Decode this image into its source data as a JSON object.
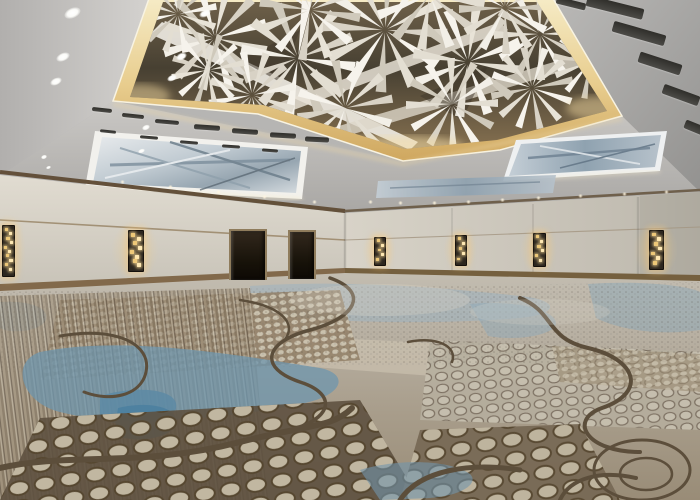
{
  "meta": {
    "description": "Empty hotel ballroom with a sculptural white folded-panel ceiling installation, warm cove lighting, backlit blue-gray ceiling art panels, beige walls with amber glass-cube sconces, two dark door openings, and a large abstract carpet in blues, taupes and browns",
    "width": 700,
    "height": 500
  },
  "palette": {
    "ceiling_light": "#d5d3d0",
    "ceiling_dark": "#9a9997",
    "cove_gold": "#e3c078",
    "sculpture_white": "#f4f1ea",
    "coffer_shadow": "#453c2f",
    "panel_art_blue": "#8fa2b0",
    "wall_beige": "#d6d1c6",
    "wood_trim": "#6b5137",
    "sconce_amber": "#ffe9b4",
    "carpet_blue": "#5d89a4",
    "carpet_blue_bright": "#4d7fa0",
    "carpet_taupe": "#927f66",
    "carpet_beige": "#c6bca6",
    "carpet_dark_vein": "#5c4e3b",
    "carpet_gray": "#b6aea0"
  },
  "scene": {
    "ceiling": {
      "downlights": [
        {
          "x": 72,
          "y": 13,
          "w": 17,
          "h": 10,
          "r": -24
        },
        {
          "x": 63,
          "y": 57,
          "w": 14,
          "h": 8,
          "r": -24
        },
        {
          "x": 56,
          "y": 81,
          "w": 12,
          "h": 7,
          "r": -24
        },
        {
          "x": 205,
          "y": 13,
          "w": 12,
          "h": 7,
          "r": -24
        },
        {
          "x": 181,
          "y": 56,
          "w": 11,
          "h": 7,
          "r": -24
        },
        {
          "x": 172,
          "y": 78,
          "w": 10,
          "h": 6,
          "r": -24
        },
        {
          "x": 146,
          "y": 127,
          "w": 8,
          "h": 5,
          "r": -22
        },
        {
          "x": 141,
          "y": 151,
          "w": 7,
          "h": 4,
          "r": -22
        },
        {
          "x": 44,
          "y": 157,
          "w": 6,
          "h": 4,
          "r": -20
        },
        {
          "x": 48,
          "y": 167,
          "w": 5,
          "h": 3,
          "r": -20
        }
      ],
      "soffit_lights": [
        {
          "x": 120,
          "y": 180
        },
        {
          "x": 168,
          "y": 185
        },
        {
          "x": 216,
          "y": 190
        },
        {
          "x": 262,
          "y": 195
        },
        {
          "x": 312,
          "y": 200
        },
        {
          "x": 368,
          "y": 200
        },
        {
          "x": 398,
          "y": 201
        },
        {
          "x": 432,
          "y": 201
        },
        {
          "x": 466,
          "y": 200
        },
        {
          "x": 500,
          "y": 198
        },
        {
          "x": 536,
          "y": 196
        },
        {
          "x": 578,
          "y": 194
        },
        {
          "x": 622,
          "y": 192
        },
        {
          "x": 664,
          "y": 190
        }
      ],
      "vents": [
        {
          "x": 92,
          "y": 108,
          "w": 20,
          "h": 4,
          "r": 6
        },
        {
          "x": 122,
          "y": 114,
          "w": 22,
          "h": 4,
          "r": 6
        },
        {
          "x": 155,
          "y": 120,
          "w": 24,
          "h": 4,
          "r": 5
        },
        {
          "x": 194,
          "y": 125,
          "w": 26,
          "h": 5,
          "r": 4
        },
        {
          "x": 232,
          "y": 129,
          "w": 26,
          "h": 5,
          "r": 4
        },
        {
          "x": 270,
          "y": 133,
          "w": 26,
          "h": 5,
          "r": 3
        },
        {
          "x": 305,
          "y": 137,
          "w": 24,
          "h": 5,
          "r": 3
        },
        {
          "x": 100,
          "y": 130,
          "w": 16,
          "h": 3,
          "r": 6
        },
        {
          "x": 140,
          "y": 136,
          "w": 18,
          "h": 3,
          "r": 5
        },
        {
          "x": 180,
          "y": 141,
          "w": 18,
          "h": 3,
          "r": 5
        },
        {
          "x": 222,
          "y": 145,
          "w": 18,
          "h": 3,
          "r": 4
        },
        {
          "x": 262,
          "y": 149,
          "w": 16,
          "h": 3,
          "r": 4
        },
        {
          "x": 556,
          "y": 0,
          "w": 30,
          "h": 7,
          "r": 14
        },
        {
          "x": 586,
          "y": 2,
          "w": 58,
          "h": 11,
          "r": 14
        },
        {
          "x": 612,
          "y": 28,
          "w": 54,
          "h": 11,
          "r": 16
        },
        {
          "x": 638,
          "y": 58,
          "w": 44,
          "h": 11,
          "r": 18
        },
        {
          "x": 662,
          "y": 90,
          "w": 38,
          "h": 10,
          "r": 20
        },
        {
          "x": 684,
          "y": 124,
          "w": 26,
          "h": 9,
          "r": 22
        }
      ],
      "fan_clusters": [
        {
          "x": 215,
          "y": 38,
          "s": 1.15,
          "r": -15
        },
        {
          "x": 298,
          "y": 58,
          "s": 1.25,
          "r": 10
        },
        {
          "x": 385,
          "y": 30,
          "s": 1.35,
          "r": 35
        },
        {
          "x": 468,
          "y": 62,
          "s": 1.2,
          "r": -20
        },
        {
          "x": 540,
          "y": 34,
          "s": 1.0,
          "r": 60
        },
        {
          "x": 252,
          "y": 95,
          "s": 0.95,
          "r": 170
        },
        {
          "x": 345,
          "y": 108,
          "s": 1.05,
          "r": 200
        },
        {
          "x": 452,
          "y": 104,
          "s": 1.0,
          "r": 150
        },
        {
          "x": 532,
          "y": 88,
          "s": 0.9,
          "r": 110
        },
        {
          "x": 178,
          "y": 14,
          "s": 0.85,
          "r": 80
        },
        {
          "x": 590,
          "y": 62,
          "s": 0.8,
          "r": 40
        },
        {
          "x": 310,
          "y": 10,
          "s": 1.1,
          "r": 130
        },
        {
          "x": 430,
          "y": -5,
          "s": 1.2,
          "r": 250
        },
        {
          "x": 505,
          "y": 8,
          "s": 1.0,
          "r": 300
        },
        {
          "x": 208,
          "y": 70,
          "s": 0.8,
          "r": 230
        }
      ]
    },
    "walls": {
      "sconces": [
        {
          "x": 2,
          "y": 225,
          "w": 11,
          "h": 50
        },
        {
          "x": 128,
          "y": 230,
          "w": 14,
          "h": 40
        },
        {
          "x": 374,
          "y": 237,
          "w": 10,
          "h": 27
        },
        {
          "x": 455,
          "y": 235,
          "w": 10,
          "h": 29
        },
        {
          "x": 533,
          "y": 233,
          "w": 11,
          "h": 32
        },
        {
          "x": 649,
          "y": 230,
          "w": 13,
          "h": 38
        }
      ],
      "doors": [
        {
          "x": 229,
          "y": 229,
          "w": 34,
          "h": 49
        },
        {
          "x": 288,
          "y": 230,
          "w": 24,
          "h": 47
        }
      ]
    }
  }
}
